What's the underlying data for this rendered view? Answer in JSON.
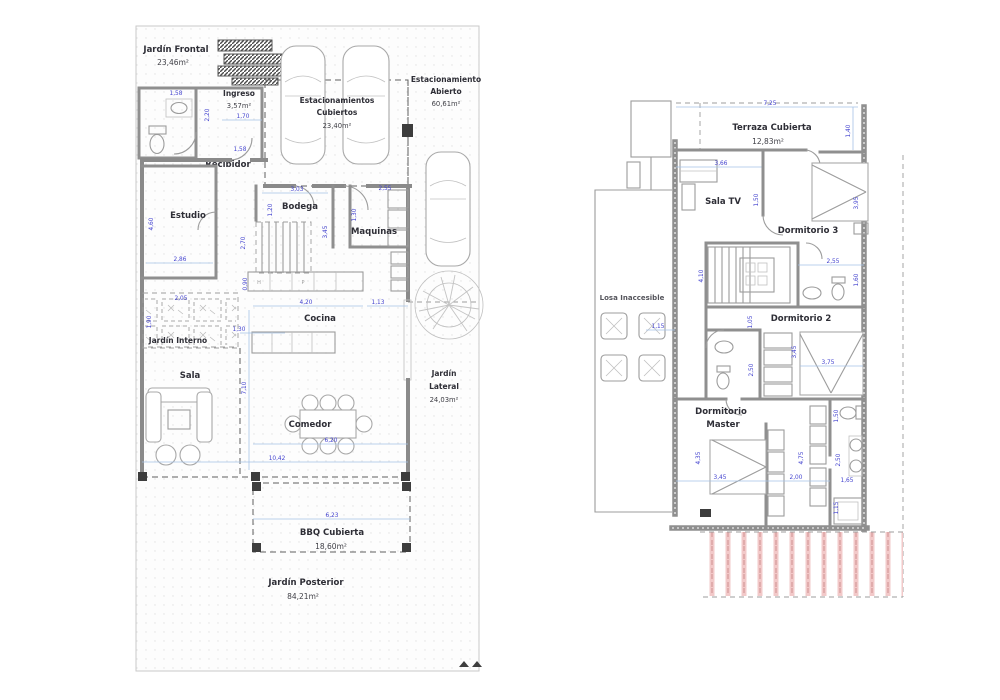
{
  "colors": {
    "wall_gray": "#8a8a8a",
    "dimension_blue": "#4343cf",
    "label_dark": "#2e2e36",
    "roof_hatch_red": "#cf8f8f",
    "dimension_line_blue": "#a5c2e6",
    "background": "#ffffff"
  },
  "floor1": {
    "jardin_frontal": {
      "label": "Jardín Frontal",
      "area": "23,46m²"
    },
    "ingreso": {
      "label": "Ingreso",
      "area": "3,57m²"
    },
    "est_cubiertos": {
      "line1": "Estacionamientos",
      "line2": "Cubiertos",
      "area": "23,40m²"
    },
    "est_abierto": {
      "line1": "Estacionamiento",
      "line2": "Abierto",
      "area": "60,61m²"
    },
    "recibidor": {
      "label": "Recibidor"
    },
    "estudio": {
      "label": "Estudio"
    },
    "bodega": {
      "label": "Bodega"
    },
    "maquinas": {
      "label": "Maquinas"
    },
    "cocina": {
      "label": "Cocina"
    },
    "jardin_interno": {
      "label": "Jardín Interno"
    },
    "sala": {
      "label": "Sala"
    },
    "comedor": {
      "label": "Comedor"
    },
    "jardin_lateral": {
      "line1": "Jardín",
      "line2": "Lateral",
      "area": "24,03m²"
    },
    "bbq": {
      "label": "BBQ Cubierta",
      "area": "18,60m²"
    },
    "jardin_posterior": {
      "label": "Jardín Posterior",
      "area": "84,21m²"
    },
    "kitchen": {
      "cell1": "H",
      "cell2": "P"
    },
    "dims": {
      "d1": "1,58",
      "d2": "2,20",
      "d3": "1,70",
      "d4": "1,58",
      "d5": "4,60",
      "d6": "2,86",
      "d7": "3,03",
      "d8": "1,20",
      "d9": "2,55",
      "d10": "1,30",
      "d11": "3,45",
      "d12": "2,70",
      "d13": "0,90",
      "d14": "4,20",
      "d15": "1,13",
      "d16": "2,05",
      "d17": "1,90",
      "d18": "1,30",
      "d19": "7,10",
      "d20": "6,20",
      "d21": "10,42",
      "d22": "6,23"
    }
  },
  "floor2": {
    "terraza": {
      "label": "Terraza Cubierta",
      "area": "12,83m²"
    },
    "sala_tv": {
      "label": "Sala TV"
    },
    "dorm3": {
      "label": "Dormitorio 3"
    },
    "dorm2": {
      "label": "Dormitorio 2"
    },
    "losa": {
      "label": "Losa Inaccesible"
    },
    "master": {
      "line1": "Dormitorio",
      "line2": "Master"
    },
    "dims": {
      "d1": "7,25",
      "d2": "1,40",
      "d3": "3,66",
      "d4": "1,50",
      "d5": "3,95",
      "d6": "2,55",
      "d7": "1,60",
      "d8": "4,10",
      "d9": "1,15",
      "d10": "1,05",
      "d11": "2,50",
      "d12": "3,45",
      "d13": "3,75",
      "d14": "4,35",
      "d15": "3,45",
      "d16": "2,00",
      "d17": "4,75",
      "d18": "1,50",
      "d19": "2,50",
      "d20": "1,65",
      "d21": "1,15"
    }
  }
}
